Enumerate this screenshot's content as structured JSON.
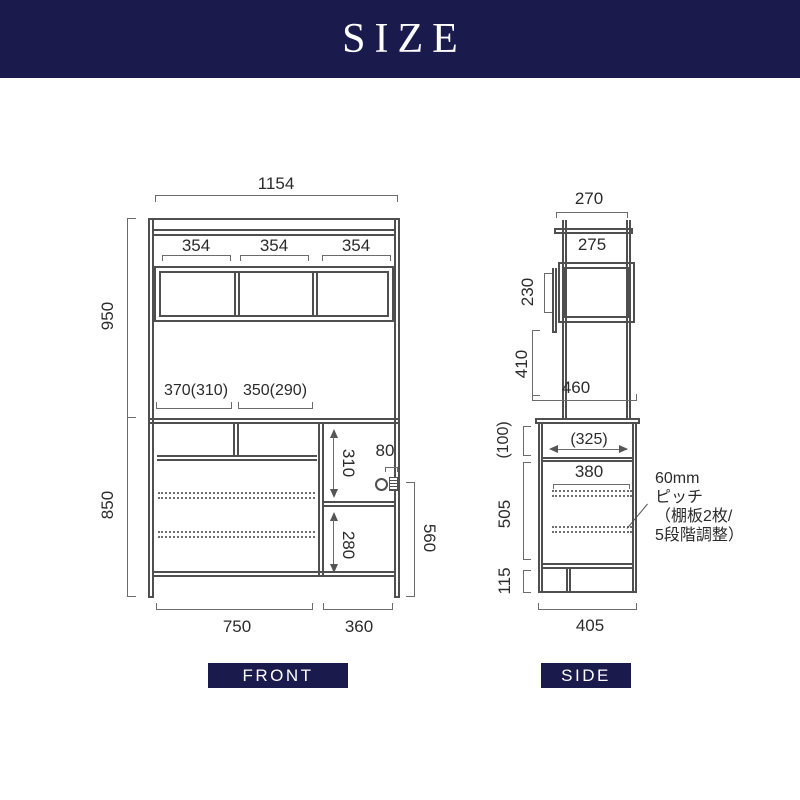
{
  "header": {
    "title": "SIZE"
  },
  "colors": {
    "navy": "#1a1a4d",
    "structure_line": "#4f4f4f",
    "dimension_line": "#6b6b6b",
    "text": "#2b2b2b",
    "background": "#ffffff"
  },
  "front_view": {
    "tag": "FRONT",
    "overall_width": "1154",
    "upper_section_height": "950",
    "lower_section_height": "850",
    "shelf_widths": [
      "354",
      "354",
      "354"
    ],
    "open_space_left": "370(310)",
    "open_space_right": "350(290)",
    "right_upper_inner_height": "310",
    "right_lower_inner_height": "280",
    "outlet_width": "80",
    "right_side_height": "560",
    "bottom_width_left": "750",
    "bottom_width_right": "360"
  },
  "side_view": {
    "tag": "SIDE",
    "top_depth": "270",
    "upper_shelf_depth": "275",
    "upper_box_height": "230",
    "middle_gap_height": "410",
    "counter_depth": "460",
    "counter_gap_height": "(100)",
    "counter_inner_depth": "(325)",
    "lower_inner_depth": "380",
    "lower_inner_height": "505",
    "base_height": "115",
    "bottom_depth": "405",
    "shelf_note_line1": "60mm",
    "shelf_note_line2": "ピッチ",
    "shelf_note_line3": "（棚板2枚/",
    "shelf_note_line4": "5段階調整）"
  }
}
